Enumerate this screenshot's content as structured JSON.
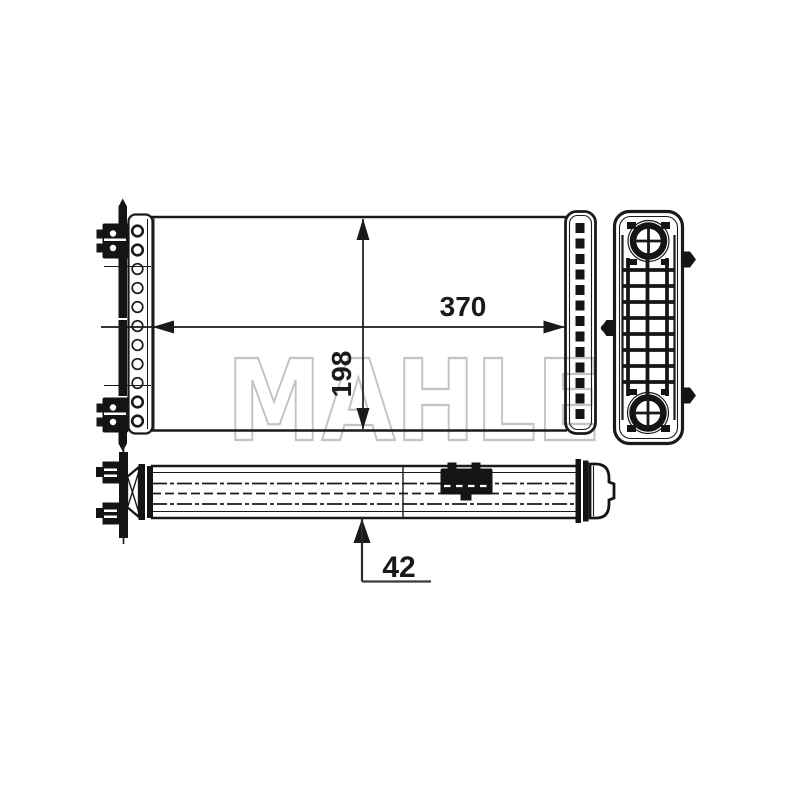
{
  "watermark": {
    "text": "MAHLE"
  },
  "dimensions": {
    "width_label": "370",
    "height_label": "198",
    "depth_label": "42"
  },
  "colors": {
    "line": "#1a1a1a",
    "fill_dark": "#141414",
    "watermark": "#c3c3c3",
    "background": "#ffffff"
  }
}
